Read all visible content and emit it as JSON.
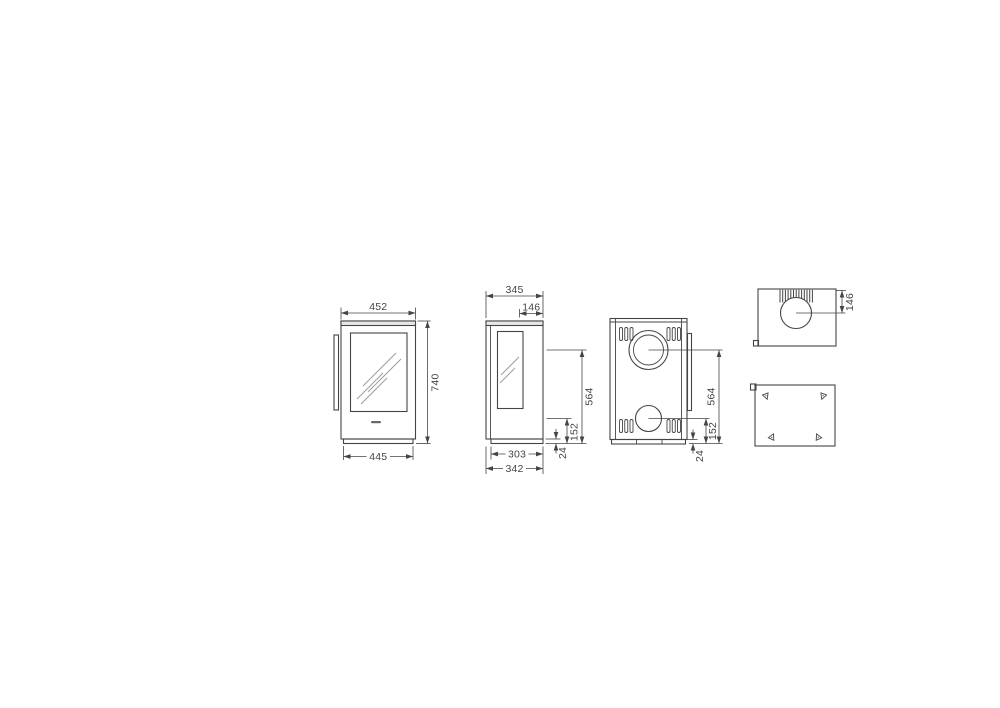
{
  "colors": {
    "background": "#ffffff",
    "line": "#454545",
    "dim_text": "#454545",
    "glass_reflection": "#9e9e9e",
    "top_plate_fill": "#e7e7e7",
    "brand_mark": "#6a6a6a"
  },
  "drawing": {
    "front": {
      "width_top": "452",
      "height": "740",
      "width_base": "445"
    },
    "side": {
      "depth": "345",
      "flue_offset": "146",
      "flue_height": "564",
      "rear_flue_height": "152",
      "plinth_height": "24",
      "plinth_depth": "303",
      "plinth_outer_depth": "342"
    },
    "back": {
      "flue_height": "564",
      "rear_flue_height": "152",
      "plinth_height": "24"
    },
    "top": {
      "flue_offset": "146"
    }
  }
}
